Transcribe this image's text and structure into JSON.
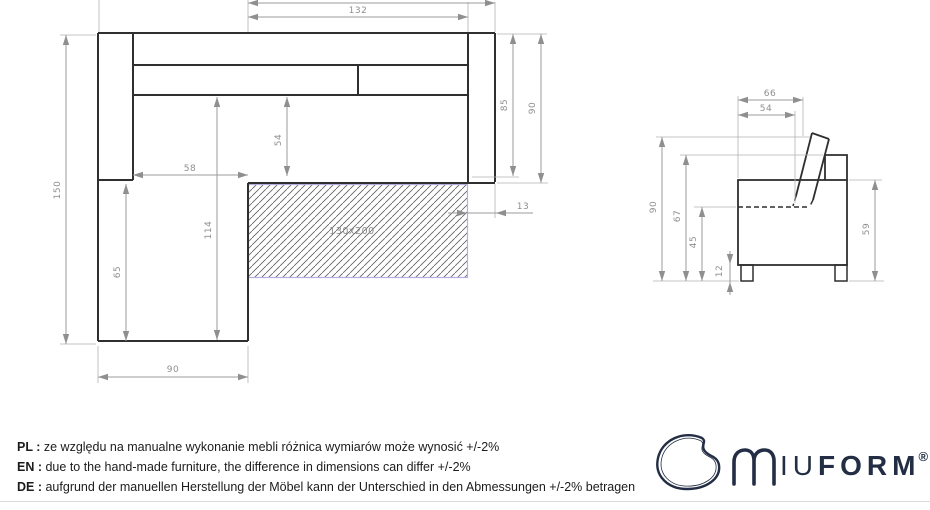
{
  "colors": {
    "outline": "#2f2f2f",
    "dimension": "#8f8f8f",
    "extension": "#b3b3b3",
    "hatch_border": "#b4aede",
    "brand": "#232e44",
    "divider": "#dcdcdc"
  },
  "top_view": {
    "labels": {
      "seat_width_132": "132",
      "armrest_depth_85": "85",
      "total_depth_90": "90",
      "armrest_width_13": "13",
      "total_length_150": "150",
      "inner_width_58": "58",
      "inner_length_114": "114",
      "seat_depth_54": "54",
      "front_length_65": "65",
      "chaise_width_90": "90",
      "mattress": "130x200"
    }
  },
  "side_view": {
    "labels": {
      "total_depth_66": "66",
      "seat_depth_54": "54",
      "total_height_90": "90",
      "back_height_67": "67",
      "seat_height_45": "45",
      "leg_height_12": "12",
      "armrest_height_59": "59"
    }
  },
  "notes": [
    {
      "lang_label": "PL :",
      "text": "ze względu na manualne wykonanie mebli różnica wymiarów może wynosić +/-2%"
    },
    {
      "lang_label": "EN :",
      "text": "due to the hand-made furniture, the difference in dimensions can differ +/-2%"
    },
    {
      "lang_label": "DE :",
      "text": "aufgrund der manuellen Herstellung der Möbel kann der Unterschied in den Abmessungen +/-2% betragen"
    }
  ],
  "logo": {
    "text_light": "IU",
    "text_bold": "FORM",
    "registered": "®"
  }
}
